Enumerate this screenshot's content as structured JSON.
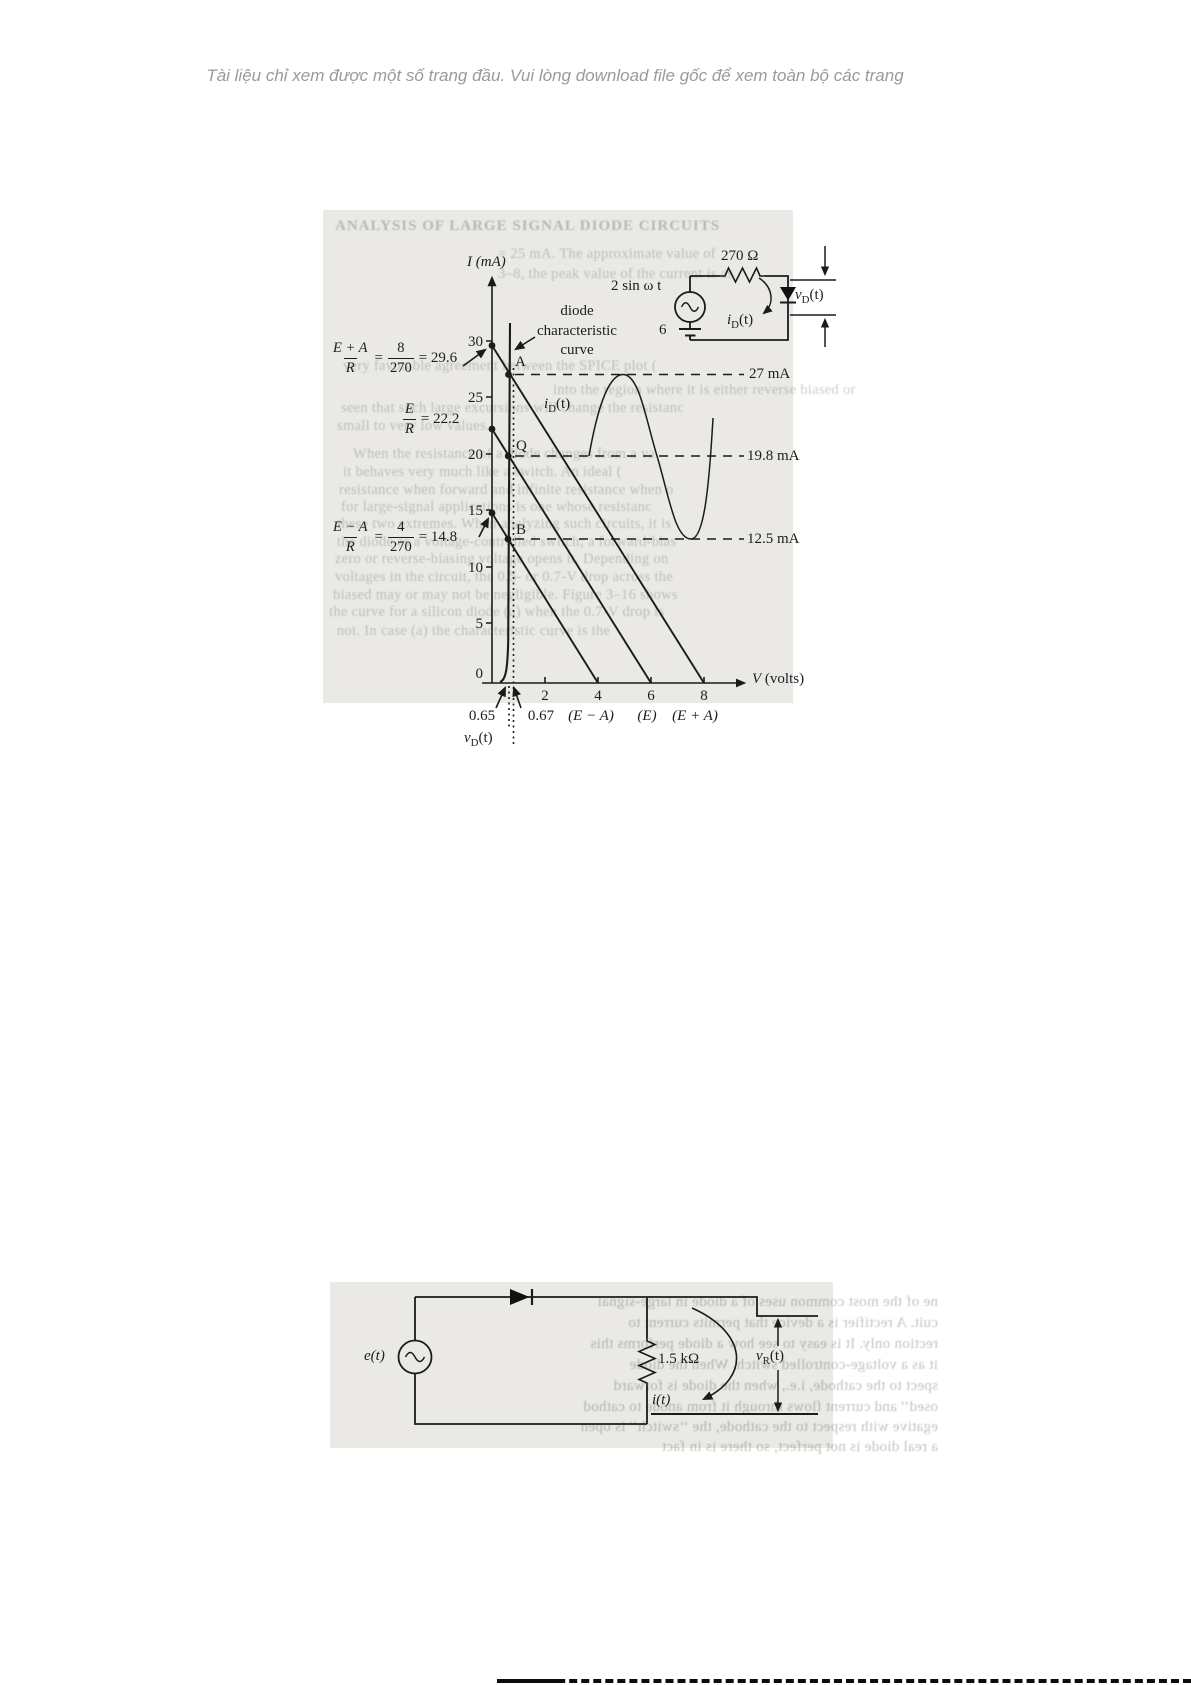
{
  "header": {
    "notice": "Tài liệu chỉ xem được một số trang đầu. Vui lòng download file gốc để xem toàn bộ các trang"
  },
  "sym": {
    "i": "i",
    "v": "v",
    "e": "e",
    "D": "D",
    "R": "R",
    "t": "(t)"
  },
  "fig1": {
    "circuit": {
      "resistor": "270 Ω",
      "source": "2 sin ω t",
      "battery": "6"
    },
    "graph": {
      "y_axis_label": "I (mA)",
      "x_axis_label": "V (volts)",
      "y_ticks": [
        "30",
        "25",
        "20",
        "15",
        "10",
        "5",
        "0"
      ],
      "x_ticks": [
        "2",
        "4",
        "6",
        "8"
      ],
      "curve_label_lines": [
        "diode",
        "characteristic",
        "curve"
      ],
      "points": {
        "a": "A",
        "q": "Q",
        "b": "B"
      },
      "dash_labels": [
        "27 mA",
        "19.8 mA",
        "12.5 mA"
      ],
      "intercepts": [
        "(E − A)",
        "(E)",
        "(E + A)"
      ],
      "knees": [
        "0.65",
        "0.67"
      ],
      "eq1": {
        "num": "E + A",
        "den": "R",
        "eq": "=",
        "frac2_num": "8",
        "frac2_den": "270",
        "result": "= 29.6"
      },
      "eq2": {
        "num": "E",
        "den": "R",
        "result": "= 22.2"
      },
      "eq3": {
        "num": "E − A",
        "den": "R",
        "eq": "=",
        "frac2_num": "4",
        "frac2_den": "270",
        "result": "= 14.8"
      }
    },
    "ghost_lines": [
      "ANALYSIS OF LARGE SIGNAL DIODE CIRCUITS",
      "= 25 mA. The approximate value of",
      "3–8, the peak value of the current is as",
      "very favorable agreement between the SPICE plot (",
      "into the region where it is either reverse biased or",
      "seen that such large excursions will change the resistanc",
      "small to very low values.",
      "When the resistance of a diode changes from a va",
      "it behaves very much like a switch. An ideal (",
      "resistance when forward and infinite resistance when o",
      "for large-signal applications is one whose resistanc",
      "these two extremes. When analyzing such circuits, it is",
      "the diode as a voltage-controlled switch; a forward-bias",
      "zero or reverse-biasing voltage opens it. Depending on",
      "voltages in the circuit, the 0.5- or 0.7-V drop across the",
      "biased may or may not be negligible. Figure 3–16 shows",
      "the curve for a silicon diode (a) when the 0.7-V drop is",
      "not. In case (a) the characteristic curve is the"
    ]
  },
  "fig2": {
    "circuit": {
      "source": "e(t)",
      "resistor": "1.5 kΩ",
      "current": "i(t)"
    },
    "ghost_lines": [
      "ne of the most common uses of a diode in large-signal",
      "cuit. A rectifier is a device that permits current to",
      "rection only. It is easy to see how a diode performs this",
      "it as a voltage-controlled switch. When the diode",
      "spect to the cathode, i.e., when the diode is forward",
      "osed’’ and current flows through it from anode to cathod",
      "egative with respect to the cathode, the ‘‘switch’’ is open",
      "a real diode is not perfect, so there is in fact"
    ]
  },
  "chart_data": {
    "type": "line",
    "title": "Diode characteristic curve with load lines",
    "xlabel": "V (volts)",
    "ylabel": "I (mA)",
    "xlim": [
      0,
      9
    ],
    "ylim": [
      0,
      32
    ],
    "x_ticks": [
      2,
      4,
      6,
      8
    ],
    "y_ticks": [
      0,
      5,
      10,
      15,
      20,
      25,
      30
    ],
    "series": [
      {
        "name": "diode characteristic curve",
        "points": [
          [
            0.6,
            0
          ],
          [
            0.65,
            5
          ],
          [
            0.66,
            15
          ],
          [
            0.67,
            30
          ]
        ]
      },
      {
        "name": "load line (E + A)/R = 8/270 = 29.6",
        "points": [
          [
            0,
            29.6
          ],
          [
            8,
            0
          ]
        ]
      },
      {
        "name": "load line E/R = 22.2",
        "points": [
          [
            0,
            22.2
          ],
          [
            6,
            0
          ]
        ]
      },
      {
        "name": "load line (E − A)/R = 4/270 = 14.8",
        "points": [
          [
            0,
            14.8
          ],
          [
            4,
            0
          ]
        ]
      },
      {
        "name": "iD(t) waveform",
        "points": [
          [
            0,
            19.8
          ],
          [
            0.25,
            27
          ],
          [
            0.5,
            19.8
          ],
          [
            0.75,
            12.5
          ],
          [
            1,
            19.8
          ]
        ]
      }
    ],
    "operating_points": [
      {
        "label": "A",
        "i_mA": 27,
        "v": 0.67
      },
      {
        "label": "Q",
        "i_mA": 19.8,
        "v": 0.66
      },
      {
        "label": "B",
        "i_mA": 12.5,
        "v": 0.65
      }
    ],
    "annotations": [
      "27 mA",
      "19.8 mA",
      "12.5 mA",
      "(E − A)",
      "(E)",
      "(E + A)",
      "0.65",
      "0.67",
      "vD(t)",
      "iD(t)"
    ]
  }
}
